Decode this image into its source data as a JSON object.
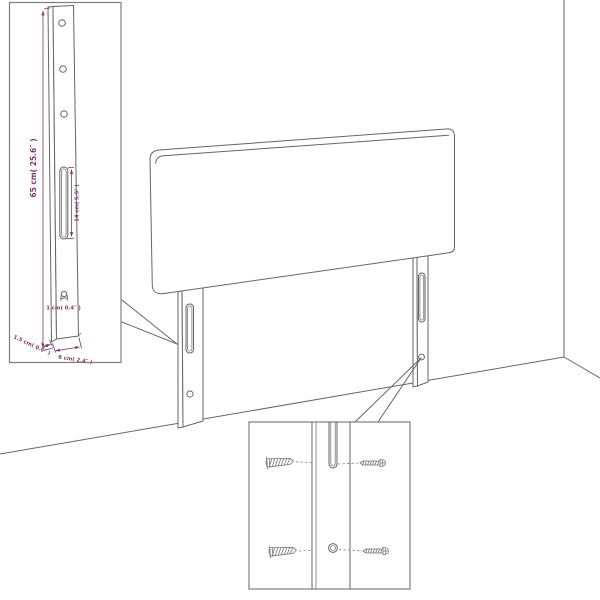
{
  "diagram": {
    "background_color": "#ffffff",
    "line_color": "#666666",
    "dimension_color": "#7d3a68"
  },
  "leg_detail_inset": {
    "labels": {
      "leg_height": "65 cm( 25.6″ )",
      "slot_length": "14 cm( 5.5″ )",
      "hole_diameter": "1 cm( 0.4″ )",
      "leg_depth": "1.5 cm( 0.6″ )",
      "leg_width": "6 cm( 2.4″ )"
    }
  }
}
